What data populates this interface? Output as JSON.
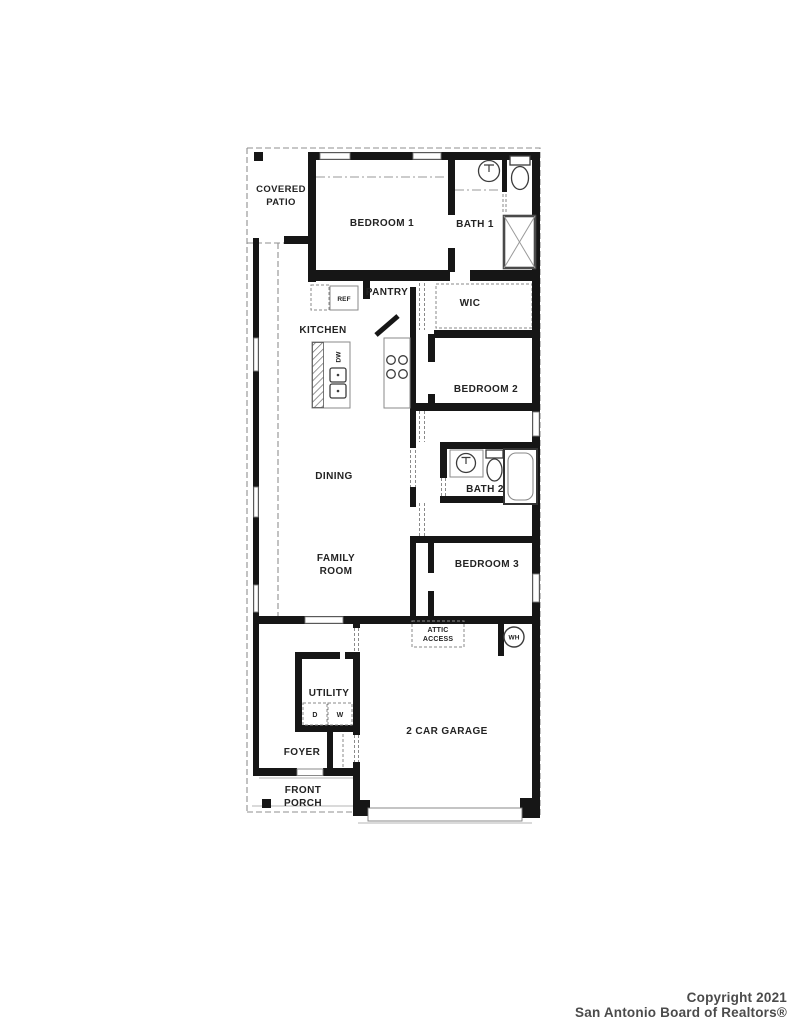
{
  "floor_plan": {
    "rooms": {
      "covered_patio": {
        "lines": [
          "COVERED",
          "PATIO"
        ]
      },
      "bedroom_1": {
        "label": "BEDROOM 1"
      },
      "bath_1": {
        "label": "BATH 1"
      },
      "pantry": {
        "label": "PANTRY"
      },
      "wic": {
        "label": "WIC"
      },
      "kitchen": {
        "label": "KITCHEN"
      },
      "bedroom_2": {
        "label": "BEDROOM 2"
      },
      "dining": {
        "label": "DINING"
      },
      "bath_2": {
        "label": "BATH 2"
      },
      "family_room": {
        "lines": [
          "FAMILY",
          "ROOM"
        ]
      },
      "bedroom_3": {
        "label": "BEDROOM 3"
      },
      "utility": {
        "label": "UTILITY"
      },
      "garage": {
        "label": "2 CAR GARAGE"
      },
      "foyer": {
        "label": "FOYER"
      },
      "front_porch": {
        "lines": [
          "FRONT",
          "PORCH"
        ]
      }
    },
    "fixtures": {
      "refrigerator": "REF",
      "dishwasher": "DW",
      "dryer": "D",
      "washer": "W",
      "water_heater": "WH",
      "attic_access": {
        "lines": [
          "ATTIC",
          "ACCESS"
        ]
      }
    }
  },
  "watermark": {
    "line1": "Copyright 2021",
    "line2": "San Antonio Board of Realtors®"
  },
  "colors": {
    "background": "#ffffff",
    "wall": "#161616",
    "dashed_line": "#8f8f8f",
    "label_text": "#232323",
    "watermark_text": "#4b4b4b"
  }
}
